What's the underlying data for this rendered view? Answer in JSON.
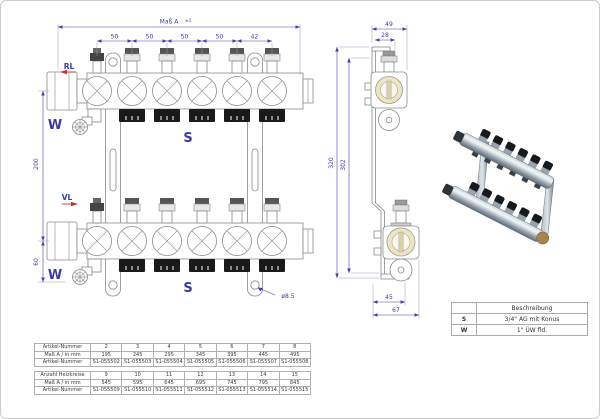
{
  "front_view": {
    "overall_dim_label": "Maß A",
    "overall_dim_tolerance": "±1",
    "port_dims": [
      "50",
      "50",
      "50",
      "50",
      "42"
    ],
    "height_dim": "200",
    "lower_height_dim": "60",
    "return_label": "RL",
    "flow_label": "VL",
    "connector_top_label": "W",
    "connector_bottom_label": "W",
    "outlet_top_label": "S",
    "outlet_bottom_label": "S",
    "hole_diameter_label": "ø8.5"
  },
  "side_view": {
    "depth_dim": "49",
    "offset_dim": "28",
    "height_outer_dim": "320",
    "height_inner_dim": "302",
    "foot_dim_inner": "45",
    "foot_dim_outer": "67"
  },
  "legend": {
    "title": "Beschreibung",
    "rows": [
      {
        "key": "S",
        "value": "3/4\" AG mit Konus"
      },
      {
        "key": "W",
        "value": "1\" ÜW fld."
      }
    ]
  },
  "spec_tables": {
    "table1": {
      "rows": [
        {
          "label": "Artikel-Nummer",
          "values": [
            "2",
            "3",
            "4",
            "5",
            "6",
            "7",
            "8"
          ]
        },
        {
          "label": "Maß A / in mm",
          "values": [
            "195",
            "245",
            "295",
            "345",
            "395",
            "445",
            "495"
          ]
        },
        {
          "label": "Artikel-Nummer",
          "values": [
            "S1-055502",
            "S1-055503",
            "S1-055504",
            "S1-055505",
            "S1-055506",
            "S1-055507",
            "S1-055508"
          ]
        }
      ]
    },
    "table2": {
      "rows": [
        {
          "label": "Anzahl Heizkreise",
          "values": [
            "9",
            "10",
            "11",
            "12",
            "13",
            "14",
            "15"
          ]
        },
        {
          "label": "Maß A / in mm",
          "values": [
            "545",
            "595",
            "645",
            "695",
            "745",
            "795",
            "845"
          ]
        },
        {
          "label": "Artikel-Nummer",
          "values": [
            "S1-055509",
            "S1-055510",
            "S1-055511",
            "S1-055512",
            "S1-055513",
            "S1-055514",
            "S1-055515"
          ]
        }
      ]
    }
  },
  "colors": {
    "dimension_blue": "#3a3aa8",
    "drawing_grey": "#8a8a8a",
    "accent_red": "#c23434",
    "sight_glass_cream": "#ece5bf",
    "socket_black": "#1a1a1a",
    "table_border": "#b0b0b0",
    "page_border": "#cccccc"
  }
}
